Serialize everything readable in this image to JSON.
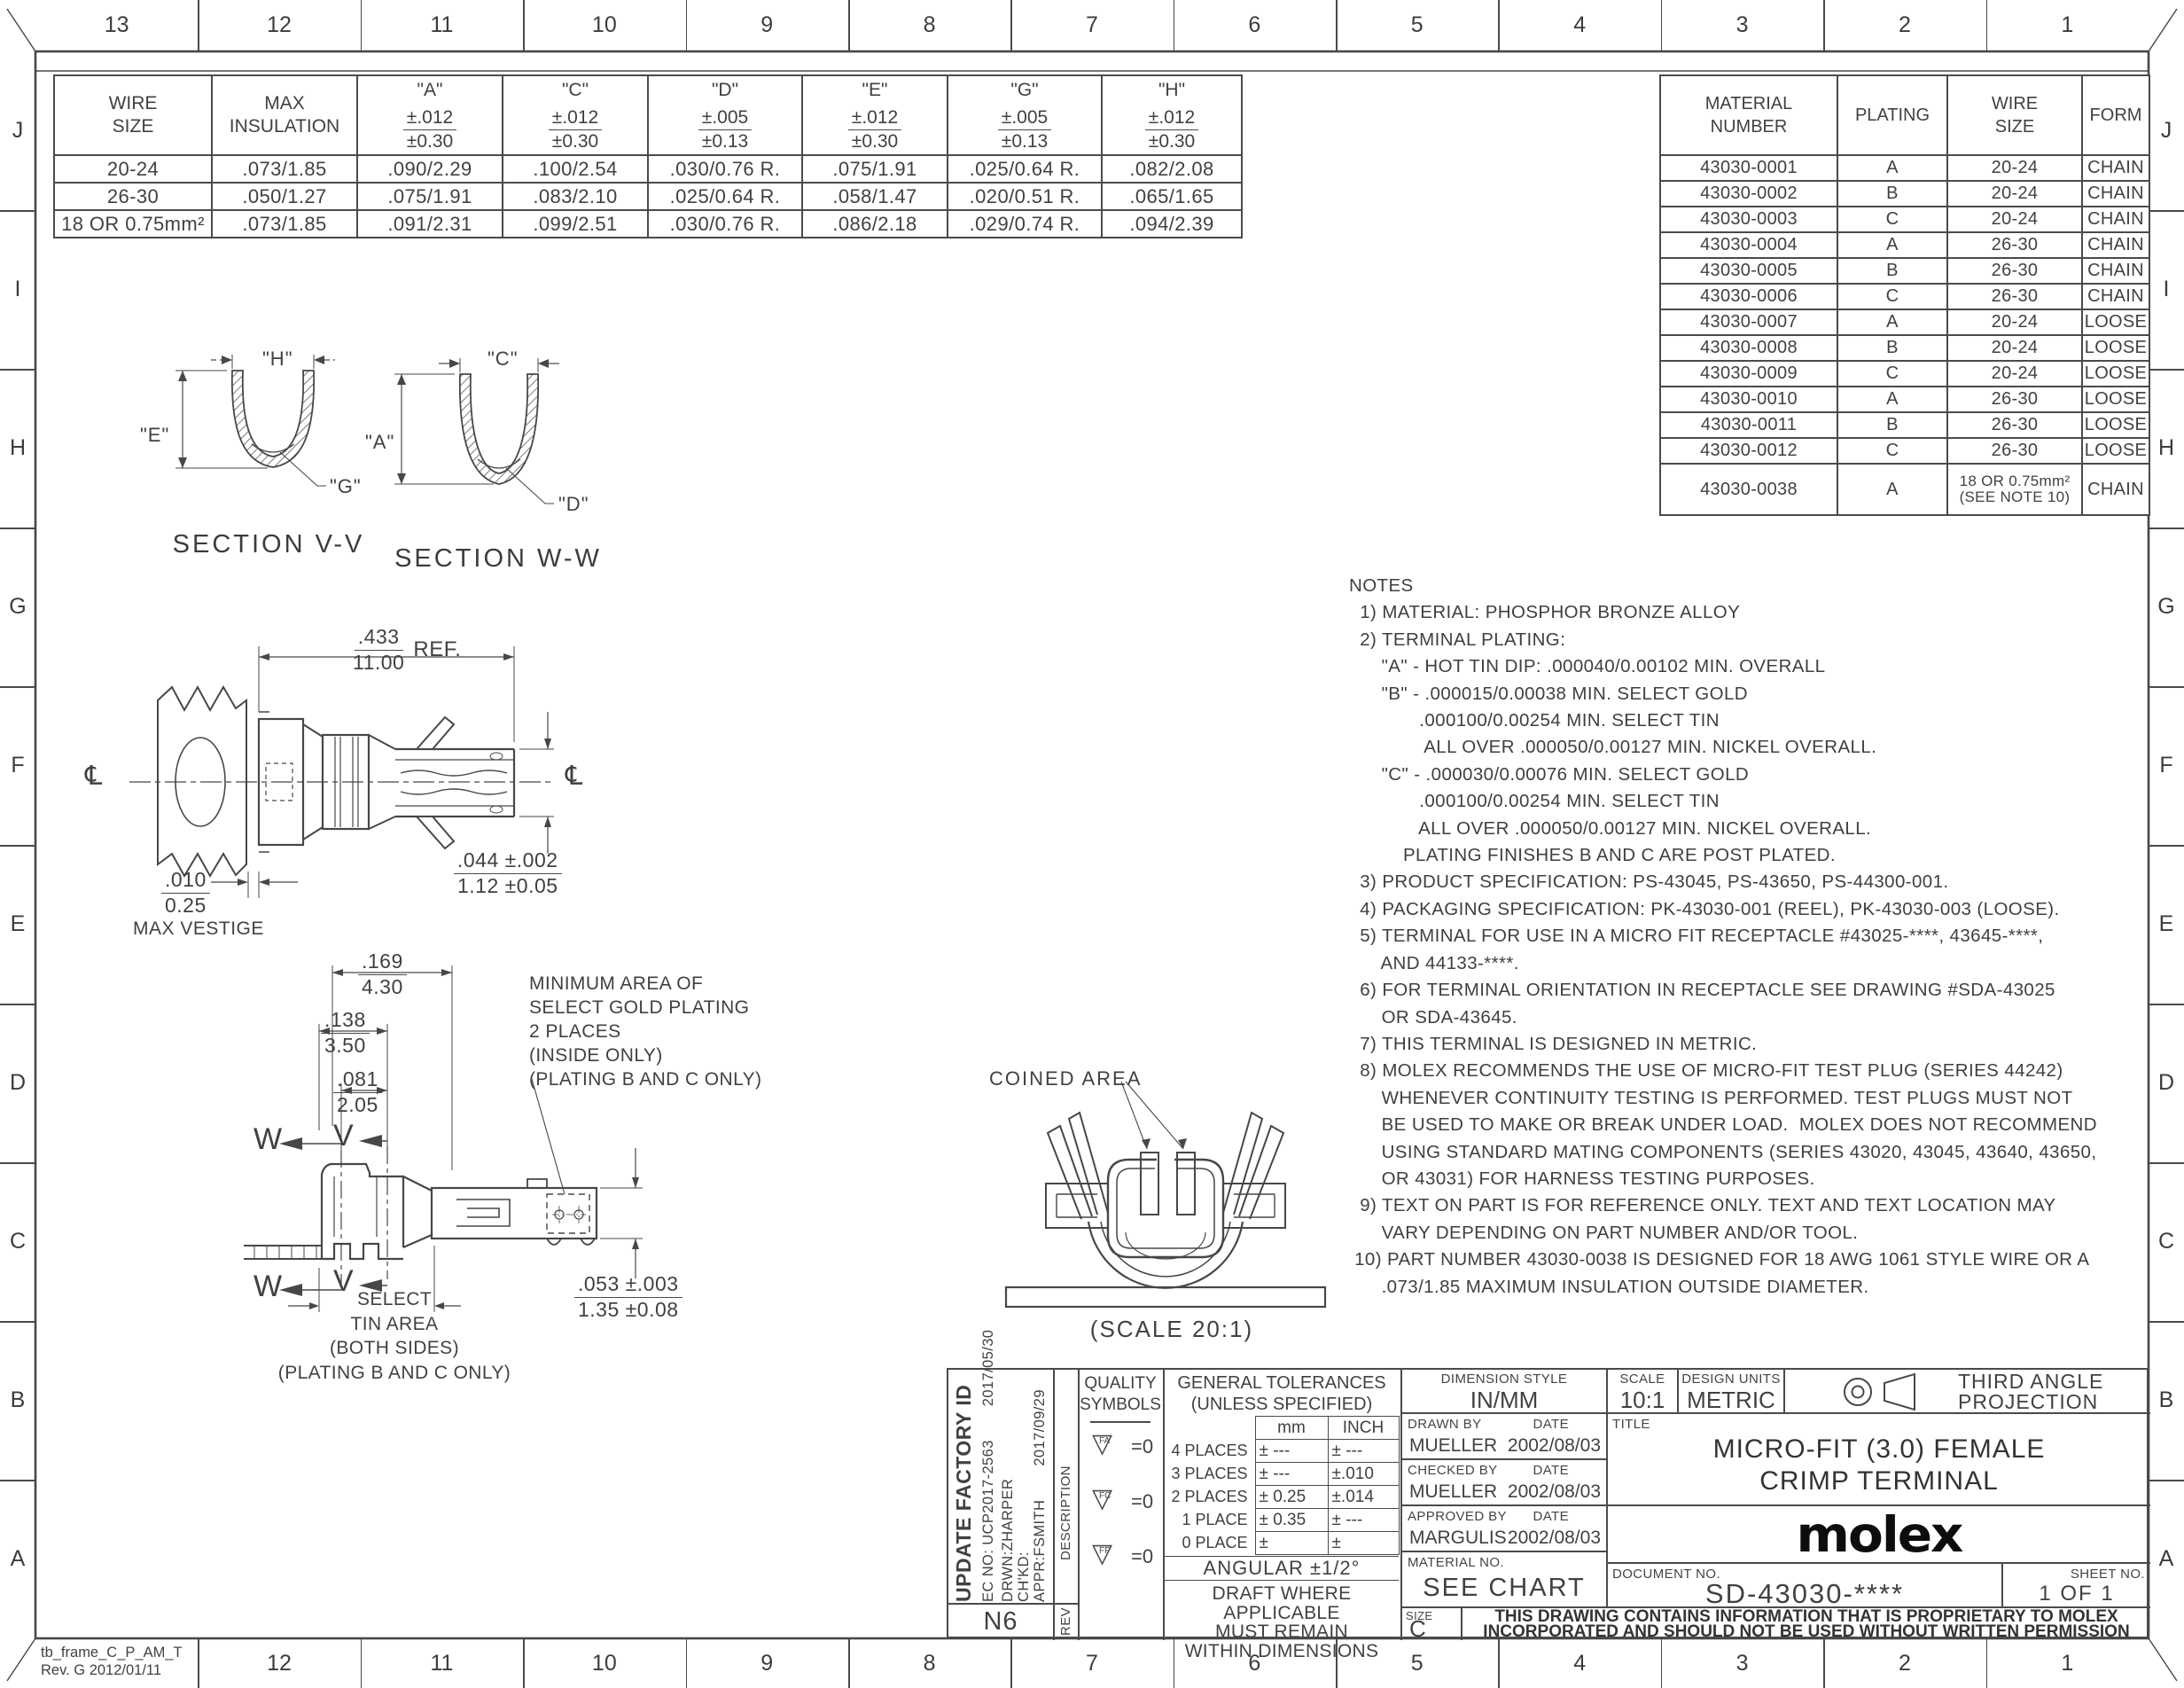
{
  "frame": {
    "top_numbers": [
      "13",
      "12",
      "11",
      "10",
      "9",
      "8",
      "7",
      "6",
      "5",
      "4",
      "3",
      "2",
      "1"
    ],
    "bottom_numbers": [
      "12",
      "11",
      "10",
      "9",
      "8",
      "7",
      "6",
      "5",
      "4",
      "3",
      "2",
      "1"
    ],
    "side_letters": [
      "J",
      "I",
      "H",
      "G",
      "F",
      "E",
      "D",
      "C",
      "B",
      "A"
    ],
    "frame_label_line1": "tb_frame_C_P_AM_T",
    "frame_label_line2": "Rev. G 2012/01/11"
  },
  "tables": {
    "dim_table": {
      "columns": [
        {
          "title": "WIRE\nSIZE"
        },
        {
          "title": "MAX\nINSULATION"
        },
        {
          "title": "\"A\"",
          "tol_in": "±.012",
          "tol_mm": "±0.30"
        },
        {
          "title": "\"C\"",
          "tol_in": "±.012",
          "tol_mm": "±0.30"
        },
        {
          "title": "\"D\"",
          "tol_in": "±.005",
          "tol_mm": "±0.13"
        },
        {
          "title": "\"E\"",
          "tol_in": "±.012",
          "tol_mm": "±0.30"
        },
        {
          "title": "\"G\"",
          "tol_in": "±.005",
          "tol_mm": "±0.13"
        },
        {
          "title": "\"H\"",
          "tol_in": "±.012",
          "tol_mm": "±0.30"
        }
      ],
      "rows": [
        [
          "20-24",
          ".073/1.85",
          ".090/2.29",
          ".100/2.54",
          ".030/0.76  R.",
          ".075/1.91",
          ".025/0.64  R.",
          ".082/2.08"
        ],
        [
          "26-30",
          ".050/1.27",
          ".075/1.91",
          ".083/2.10",
          ".025/0.64  R.",
          ".058/1.47",
          ".020/0.51  R.",
          ".065/1.65"
        ],
        [
          "18 OR 0.75mm²",
          ".073/1.85",
          ".091/2.31",
          ".099/2.51",
          ".030/0.76  R.",
          ".086/2.18",
          ".029/0.74  R.",
          ".094/2.39"
        ]
      ]
    },
    "part_table": {
      "columns": [
        "MATERIAL\nNUMBER",
        "PLATING",
        "WIRE\nSIZE",
        "FORM"
      ],
      "rows": [
        [
          "43030-0001",
          "A",
          "20-24",
          "CHAIN"
        ],
        [
          "43030-0002",
          "B",
          "20-24",
          "CHAIN"
        ],
        [
          "43030-0003",
          "C",
          "20-24",
          "CHAIN"
        ],
        [
          "43030-0004",
          "A",
          "26-30",
          "CHAIN"
        ],
        [
          "43030-0005",
          "B",
          "26-30",
          "CHAIN"
        ],
        [
          "43030-0006",
          "C",
          "26-30",
          "CHAIN"
        ],
        [
          "43030-0007",
          "A",
          "20-24",
          "LOOSE"
        ],
        [
          "43030-0008",
          "B",
          "20-24",
          "LOOSE"
        ],
        [
          "43030-0009",
          "C",
          "20-24",
          "LOOSE"
        ],
        [
          "43030-0010",
          "A",
          "26-30",
          "LOOSE"
        ],
        [
          "43030-0011",
          "B",
          "26-30",
          "LOOSE"
        ],
        [
          "43030-0012",
          "C",
          "26-30",
          "LOOSE"
        ],
        [
          "43030-0038",
          "A",
          "18 OR 0.75mm²\n(SEE NOTE 10)",
          "CHAIN"
        ]
      ]
    },
    "tolerances": {
      "title_line1": "GENERAL TOLERANCES",
      "title_line2": "(UNLESS SPECIFIED)",
      "col_mm": "mm",
      "col_inch": "INCH",
      "rows": [
        [
          "4 PLACES",
          "± ---",
          "± ---"
        ],
        [
          "3 PLACES",
          "± ---",
          "±.010"
        ],
        [
          "2 PLACES",
          "± 0.25",
          "±.014"
        ],
        [
          "1 PLACE",
          "± 0.35",
          "± ---"
        ],
        [
          "0 PLACE",
          "±",
          "±"
        ]
      ],
      "angular": "ANGULAR ±1/2°",
      "draft_note": "DRAFT WHERE APPLICABLE\nMUST REMAIN\nWITHIN DIMENSIONS"
    }
  },
  "views": {
    "section_vv": {
      "label": "SECTION V-V",
      "dim_h": "\"H\"",
      "dim_e": "\"E\"",
      "dim_g": "\"G\""
    },
    "section_ww": {
      "label": "SECTION W-W",
      "dim_c": "\"C\"",
      "dim_a": "\"A\"",
      "dim_d": "\"D\""
    },
    "side_view": {
      "length_in": ".433",
      "length_mm": "11.00",
      "length_ref": "REF.",
      "tip_in": ".044 ±.002",
      "tip_mm": "1.12 ±0.05",
      "vestige_in": ".010",
      "vestige_mm": "0.25",
      "vestige_label": "MAX VESTIGE",
      "centerline": "℄"
    },
    "flat_view": {
      "dim1_in": ".169",
      "dim1_mm": "4.30",
      "dim2_in": ".138",
      "dim2_mm": "3.50",
      "dim3_in": ".081",
      "dim3_mm": "2.05",
      "dim4_in": ".053 ±.003",
      "dim4_mm": "1.35 ±0.08",
      "cut_w": "W",
      "cut_v": "V",
      "tin_note": "SELECT\nTIN AREA\n(BOTH SIDES)\n(PLATING B AND C ONLY)",
      "gold_note": "MINIMUM AREA OF\nSELECT GOLD PLATING\n2 PLACES\n(INSIDE ONLY)\n(PLATING B AND C ONLY)"
    },
    "front_view": {
      "coined_label": "COINED AREA",
      "scale_label": "(SCALE 20:1)"
    }
  },
  "notes": {
    "lines": [
      "NOTES",
      "  1) MATERIAL: PHOSPHOR BRONZE ALLOY",
      "  2) TERMINAL PLATING:",
      "      \"A\" - HOT TIN DIP: .000040/0.00102 MIN. OVERALL",
      "      \"B\" - .000015/0.00038 MIN. SELECT GOLD",
      "             .000100/0.00254 MIN. SELECT TIN",
      "              ALL OVER .000050/0.00127 MIN. NICKEL OVERALL.",
      "      \"C\" - .000030/0.00076 MIN. SELECT GOLD",
      "             .000100/0.00254 MIN. SELECT TIN",
      "             ALL OVER .000050/0.00127 MIN. NICKEL OVERALL.",
      "          PLATING FINISHES B AND C ARE POST PLATED.",
      "  3) PRODUCT SPECIFICATION: PS-43045, PS-43650, PS-44300-001.",
      "  4) PACKAGING SPECIFICATION: PK-43030-001 (REEL), PK-43030-003 (LOOSE).",
      "  5) TERMINAL FOR USE IN A MICRO FIT RECEPTACLE #43025-****, 43645-****,",
      "      AND 44133-****.",
      "  6) FOR TERMINAL ORIENTATION IN RECEPTACLE SEE DRAWING #SDA-43025",
      "      OR SDA-43645.",
      "  7) THIS TERMINAL IS DESIGNED IN METRIC.",
      "  8) MOLEX RECOMMENDS THE USE OF MICRO-FIT TEST PLUG (SERIES 44242)",
      "      WHENEVER CONTINUITY TESTING IS PERFORMED. TEST PLUGS MUST NOT",
      "      BE USED TO MAKE OR BREAK UNDER LOAD.  MOLEX DOES NOT RECOMMEND",
      "      USING STANDARD MATING COMPONENTS (SERIES 43020, 43045, 43640, 43650,",
      "      OR 43031) FOR HARNESS TESTING PURPOSES.",
      "  9) TEXT ON PART IS FOR REFERENCE ONLY. TEXT AND TEXT LOCATION MAY",
      "      VARY DEPENDING ON PART NUMBER AND/OR TOOL.",
      " 10) PART NUMBER 43030-0038 IS DESIGNED FOR 18 AWG 1061 STYLE WIRE OR A",
      "      .073/1.85 MAXIMUM INSULATION OUTSIDE DIAMETER."
    ]
  },
  "title_block": {
    "revision": {
      "description_bold": "UPDATE FACTORY ID",
      "ec": "EC NO: UCP2017-2563",
      "date1": "2017/05/30",
      "drwn": "DRWN:ZHARPER",
      "chkd": "CH'KD:",
      "appr": "APPR:FSMITH",
      "date2": "2017/09/29",
      "rev_value": "N6",
      "description_col": "DESCRIPTION",
      "rev_col": "REV"
    },
    "quality": {
      "title": "QUALITY\nSYMBOLS",
      "flag_glyph": "▽",
      "flags": [
        {
          "label": "FA"
        },
        {
          "label": "FC"
        },
        {
          "label": "FP"
        }
      ],
      "value": "=0"
    },
    "dimension_style_label": "DIMENSION STYLE",
    "dimension_style": "IN/MM",
    "scale_label": "SCALE",
    "scale": "10:1",
    "design_units_label": "DESIGN UNITS",
    "design_units": "METRIC",
    "projection": "THIRD ANGLE\nPROJECTION",
    "drawn_by_label": "DRAWN BY",
    "date_label": "DATE",
    "drawn_by": "MUELLER",
    "drawn_date": "2002/08/03",
    "checked_by_label": "CHECKED BY",
    "checked_by": "MUELLER",
    "checked_date": "2002/08/03",
    "approved_by_label": "APPROVED BY",
    "approved_by": "MARGULIS",
    "approved_date": "2002/08/03",
    "title_label": "TITLE",
    "title": "MICRO-FIT (3.0) FEMALE\nCRIMP TERMINAL",
    "logo": "molex",
    "material_label": "MATERIAL NO.",
    "material": "SEE CHART",
    "document_label": "DOCUMENT NO.",
    "document": "SD-43030-****",
    "sheet_label": "SHEET NO.",
    "sheet": "1 OF 1",
    "size_label": "SIZE",
    "size": "C",
    "proprietary": "THIS DRAWING CONTAINS INFORMATION THAT IS PROPRIETARY TO MOLEX\nINCORPORATED AND SHOULD NOT BE USED WITHOUT WRITTEN PERMISSION"
  }
}
